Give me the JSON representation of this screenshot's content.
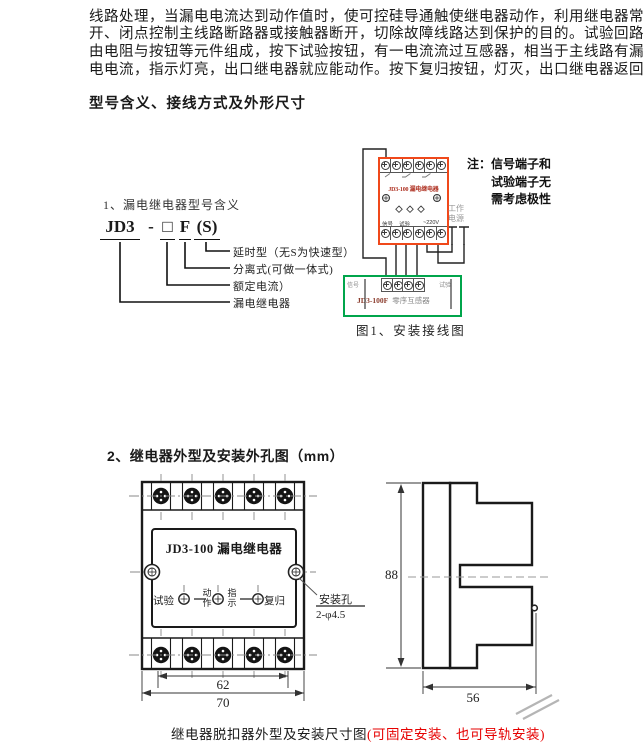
{
  "intro": {
    "lines": [
      "线路处理，当漏电电流达到动作值时，使可控硅导通触使继电器动作，利用继电器常",
      "开、闭点控制主线路断路器或接触器断开，切除故障线路达到保护的目的。试验回路",
      "由电阻与按钮等元件组成，按下试验按钮，有一电流流过互感器，相当于主线路有漏",
      "电电流，指示灯亮，出口继电器就应能动作。按下复归按钮，灯灭，出口继电器返回。"
    ]
  },
  "model_section": {
    "heading": "型号含义、接线方式及外形尺寸",
    "subtitle": "1、漏电继电器型号含义",
    "code": {
      "series": "JD3",
      "dash": "-",
      "box": "□",
      "separate": "F",
      "delay": "(S)"
    },
    "legend": [
      "延时型（无S为快速型）",
      "分离式(可做一体式)",
      "额定电流）",
      "漏电继电器"
    ]
  },
  "wiring": {
    "relay_name": "JD3-100 漏电继电器",
    "terminal_labels": {
      "signal": "信号",
      "test": "试验",
      "voltage": "~220V"
    },
    "note": [
      "注：信号端子和",
      "试验端子无",
      "需考虑极性"
    ],
    "power": [
      "工作",
      "电源"
    ],
    "ct": {
      "left": "信号",
      "right": "试验",
      "name": "JD3-100F",
      "type": "零序互感器"
    },
    "caption": "图1、安装接线图"
  },
  "outline_section": {
    "heading": "2、继电器外型及安装外孔图（mm）",
    "front": {
      "name": "JD3-100 漏电继电器",
      "test": "试验",
      "action": [
        "动",
        "作"
      ],
      "indicate": [
        "指",
        "示"
      ],
      "reset": "复归",
      "hole_label": "安装孔",
      "hole_spec": "2-φ4.5",
      "dim_inner": "62",
      "dim_outer": "70"
    },
    "side": {
      "height": "88",
      "depth": "56"
    }
  },
  "footer": {
    "black": "继电器脱扣器外型及安装尺寸图",
    "red": "(可固定安装、也可导轨安装)"
  },
  "colors": {
    "relay_outline": "#f0481a",
    "ct_outline": "#00a54b",
    "relay_text": "#b03425",
    "footer_red": "#e60000"
  }
}
